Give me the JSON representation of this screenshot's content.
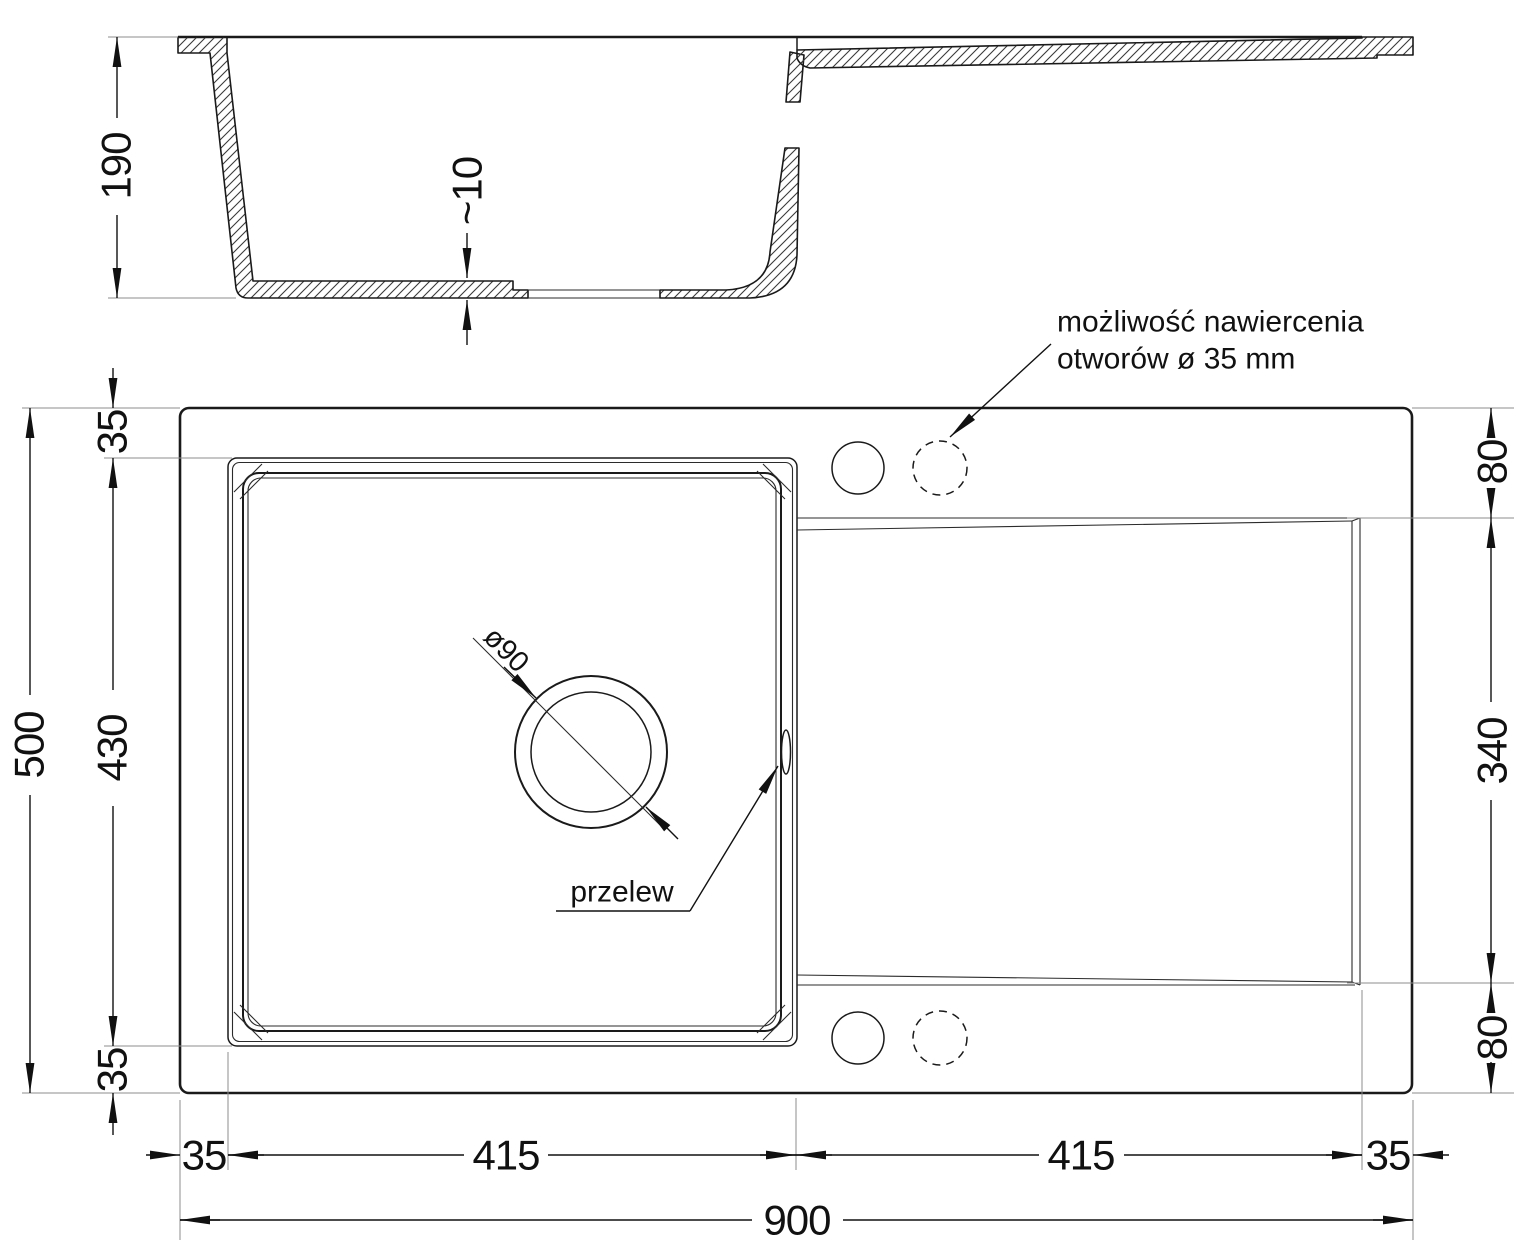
{
  "dims": {
    "depth": "190",
    "bottom_thickness": "~10",
    "side_overall": "500",
    "side_bowl": "430",
    "side_edge_top": "35",
    "side_edge_bottom": "35",
    "right_top": "80",
    "right_drainer": "340",
    "right_bottom": "80",
    "bottom_edge_left": "35",
    "bottom_bowl": "415",
    "bottom_drainer": "415",
    "bottom_edge_right": "35",
    "overall_length": "900",
    "drain_diameter": "ø90"
  },
  "labels": {
    "overflow": "przelew",
    "drill_note_line1": "możliwość nawiercenia",
    "drill_note_line2": "otworów ø 35 mm"
  },
  "colors": {
    "line": "#1a1a1a",
    "extension_line": "#8c8c8c",
    "background": "#ffffff"
  }
}
